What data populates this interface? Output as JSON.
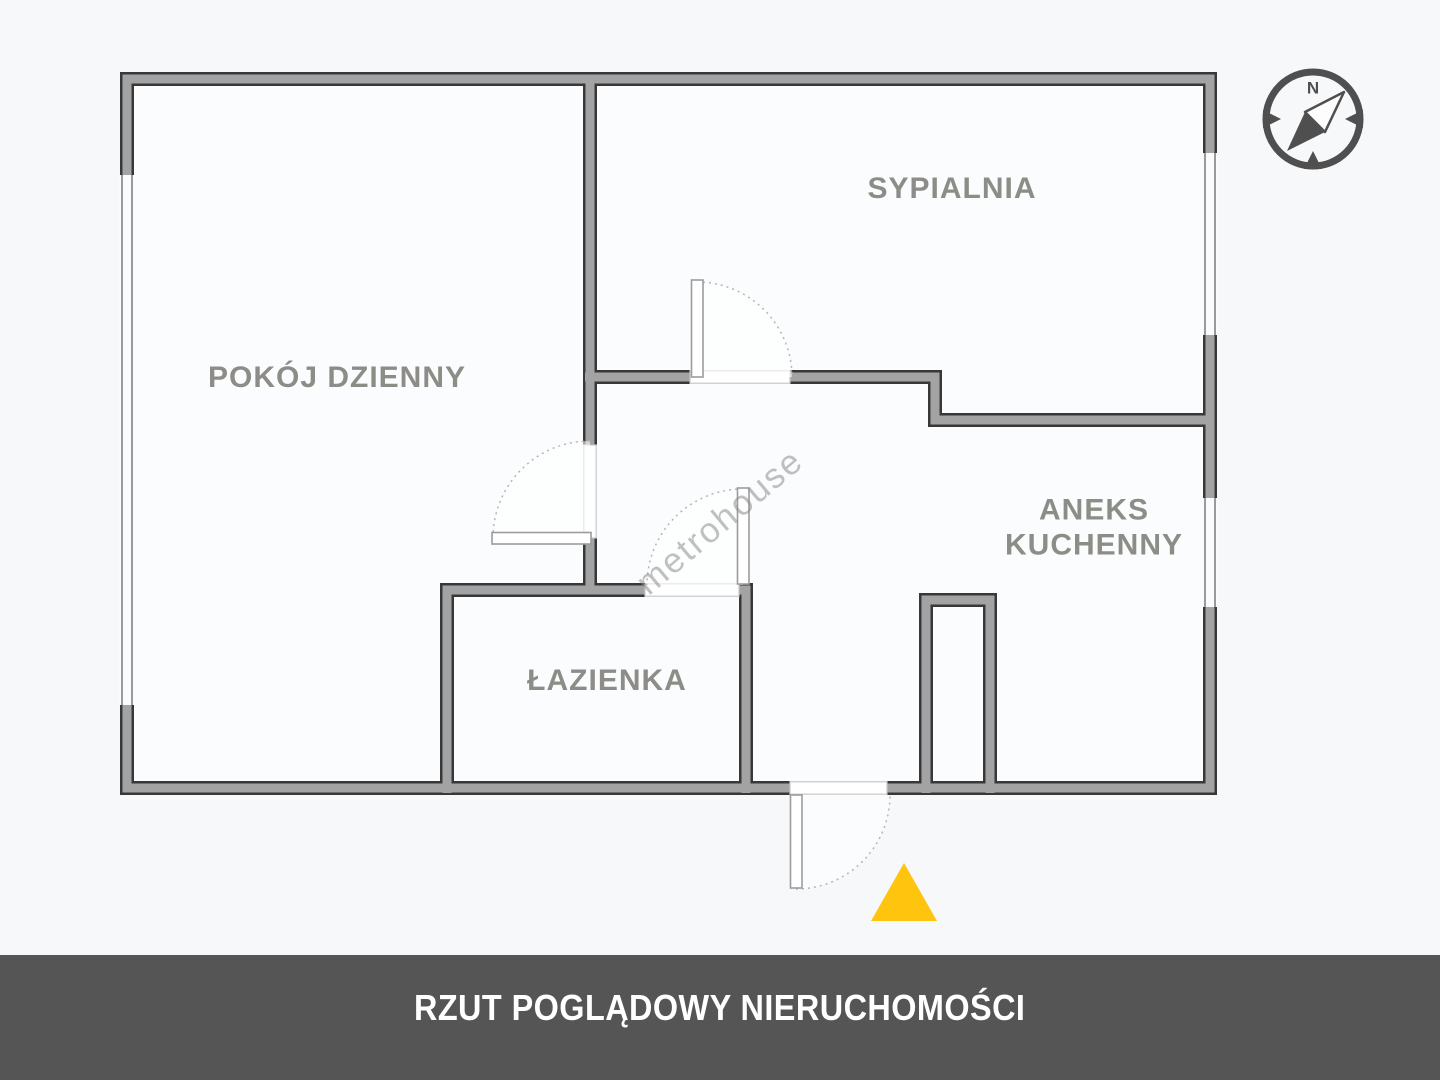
{
  "page": {
    "background_color": "#f7f8fa"
  },
  "plan": {
    "wall_fill_color": "#a3a3a3",
    "wall_outline_color": "#383838",
    "floor_color": "#fbfcfd",
    "window_line_color": "#9a9a9a",
    "door_line_color": "#9c9c9c",
    "label_color": "#8d8d88"
  },
  "rooms": {
    "sypialnia": {
      "label": "SYPIALNIA"
    },
    "pokoj_dzienny": {
      "label": "POKÓJ DZIENNY"
    },
    "aneks_kuchenny": {
      "label": "ANEKS KUCHENNY"
    },
    "lazienka": {
      "label": "ŁAZIENKA"
    }
  },
  "watermark": {
    "text": "metrohouse"
  },
  "compass": {
    "north_label": "N",
    "color": "#4f4f4f"
  },
  "entrance_marker": {
    "shape": "triangle-up",
    "color": "#ffc40e"
  },
  "footer": {
    "title": "RZUT POGLĄDOWY NIERUCHOMOŚCI",
    "background_color": "#555555",
    "text_color": "#ffffff"
  }
}
